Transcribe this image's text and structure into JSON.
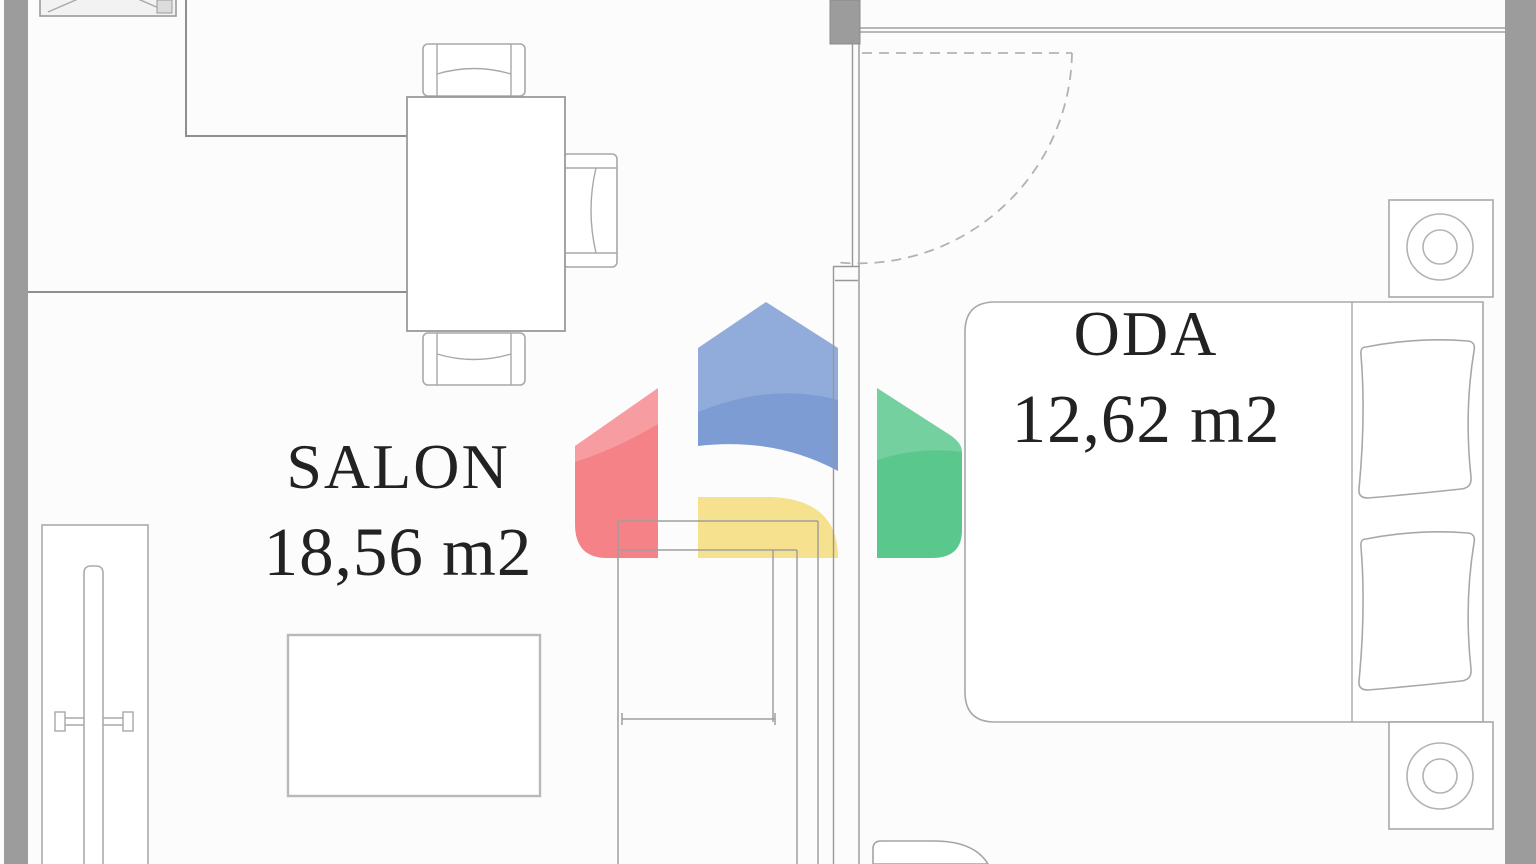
{
  "page": {
    "background": "#fcfcfc"
  },
  "watermark": {
    "colors": {
      "red": "#f58287",
      "blue": "#7d9cd3",
      "yellow": "#f6e28e",
      "green": "#5ac88d"
    }
  },
  "plan": {
    "wall_fill": "#9c9c9c",
    "wall_line": "#8f8f8f",
    "furniture_line": "#a8a8a8",
    "label_color": "#222222",
    "rooms": [
      {
        "name": "SALON",
        "area": "18,56 m2"
      },
      {
        "name": "ODA",
        "area": "12,62 m2"
      }
    ]
  }
}
